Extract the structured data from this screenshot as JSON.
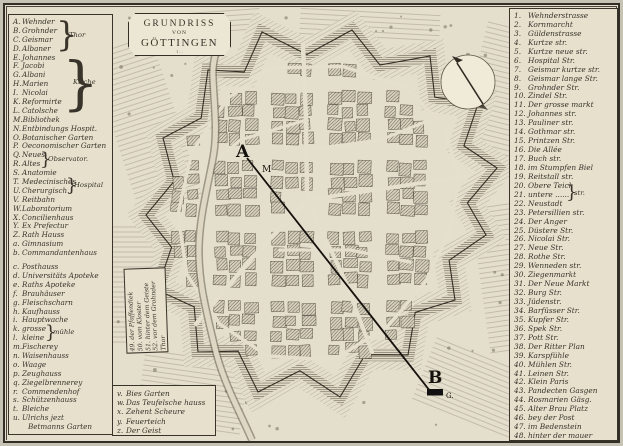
{
  "palette": {
    "paper": "#e4decc",
    "ink": "#39342b",
    "margin": "#c7c3b4",
    "hatch": "#554f41"
  },
  "title": {
    "line1": "GRUNDRISS",
    "line2": "VON",
    "line3": "GÖTTINGEN",
    "scale_mark": "1 : ."
  },
  "left_legend": {
    "brace_glyph": "}",
    "braces": {
      "thor": "Thor",
      "kirche": "Kirche",
      "observatory": "Observator.",
      "hospital": "Hospital",
      "muehle": "mühle"
    },
    "items": [
      {
        "k": "A.",
        "t": "Wehnder"
      },
      {
        "k": "B.",
        "t": "Grohnder"
      },
      {
        "k": "C.",
        "t": "Geismar"
      },
      {
        "k": "D.",
        "t": "Albaner"
      },
      {
        "k": "E.",
        "t": "Johannes"
      },
      {
        "k": "F.",
        "t": "Jacobi"
      },
      {
        "k": "G.",
        "t": "Albani"
      },
      {
        "k": "H.",
        "t": "Marien"
      },
      {
        "k": "I.",
        "t": "Nicolai"
      },
      {
        "k": "K.",
        "t": "Reformirte"
      },
      {
        "k": "L.",
        "t": "Catolsche"
      },
      {
        "k": "M.",
        "t": "Bibliothek"
      },
      {
        "k": "N.",
        "t": "Entbindungs Hospit."
      },
      {
        "k": "O.",
        "t": "Botanischer Garten"
      },
      {
        "k": "P.",
        "t": "Oeconomischer Garten"
      },
      {
        "k": "Q.",
        "t": "Neues"
      },
      {
        "k": "R.",
        "t": "Altes"
      },
      {
        "k": "S.",
        "t": "Anatomie"
      },
      {
        "k": "T.",
        "t": "Medecinisches"
      },
      {
        "k": "U.",
        "t": "Cherurgisch."
      },
      {
        "k": "V.",
        "t": "Reitbahn"
      },
      {
        "k": "W.",
        "t": "Laboratorium"
      },
      {
        "k": "X.",
        "t": "Concilienhaus"
      },
      {
        "k": "Y.",
        "t": "Ex Prefectur"
      },
      {
        "k": "Z.",
        "t": "Rath Hauss"
      },
      {
        "k": "a.",
        "t": "Gimnasium"
      },
      {
        "k": "b.",
        "t": "Commandantenhaus"
      },
      {
        "k": "c.",
        "t": "Posthauss"
      },
      {
        "k": "d.",
        "t": "Universitäts Apoteke"
      },
      {
        "k": "e.",
        "t": "Raths Apoteke"
      },
      {
        "k": "f.",
        "t": "Brauhäuser"
      },
      {
        "k": "g.",
        "t": "Fleischscharn"
      },
      {
        "k": "h.",
        "t": "Kaufhauss"
      },
      {
        "k": "i.",
        "t": "Hauptwache"
      },
      {
        "k": "k.",
        "t": "grosse"
      },
      {
        "k": "l.",
        "t": "kleine"
      },
      {
        "k": "m.",
        "t": "Fischerey"
      },
      {
        "k": "n.",
        "t": "Waisenhauss"
      },
      {
        "k": "o.",
        "t": "Waage"
      },
      {
        "k": "p.",
        "t": "Zeughauss"
      },
      {
        "k": "q.",
        "t": "Ziegelbrennerey"
      },
      {
        "k": "r.",
        "t": "Commendenhof"
      },
      {
        "k": "s.",
        "t": "Schützenhauss"
      },
      {
        "k": "t.",
        "t": "Bleiche"
      },
      {
        "k": "u.",
        "t": "Ulrichs jezt"
      },
      {
        "k": "",
        "t": "Betmanns Garten"
      }
    ]
  },
  "right_legend": {
    "brace_glyph": "}",
    "brace_label": "str.",
    "items": [
      {
        "n": "1.",
        "t": "Wehnderstrasse"
      },
      {
        "n": "2.",
        "t": "Kornmarcht"
      },
      {
        "n": "3.",
        "t": "Güldenstrasse"
      },
      {
        "n": "4.",
        "t": "Kurtze str."
      },
      {
        "n": "5.",
        "t": "Kurtze neue str."
      },
      {
        "n": "6.",
        "t": "Hospital Str."
      },
      {
        "n": "7.",
        "t": "Geismar kurtze str."
      },
      {
        "n": "8.",
        "t": "Geismar lange Str."
      },
      {
        "n": "9.",
        "t": "Grohnder Str."
      },
      {
        "n": "10.",
        "t": "Zindel Str."
      },
      {
        "n": "11.",
        "t": "Der grosse markt"
      },
      {
        "n": "12.",
        "t": "Johannes str."
      },
      {
        "n": "13.",
        "t": "Pauliner str."
      },
      {
        "n": "14.",
        "t": "Gothmar str."
      },
      {
        "n": "15.",
        "t": "Printzen Str."
      },
      {
        "n": "16.",
        "t": "Die Allée"
      },
      {
        "n": "17.",
        "t": "Buch str."
      },
      {
        "n": "18.",
        "t": "im Stumpfen Biel"
      },
      {
        "n": "19.",
        "t": "Reitstall str."
      },
      {
        "n": "20.",
        "t": "Obere Teich"
      },
      {
        "n": "21.",
        "t": "untere ......"
      },
      {
        "n": "22.",
        "t": "Neustadt"
      },
      {
        "n": "23.",
        "t": "Petersillien str."
      },
      {
        "n": "24.",
        "t": "Der Anger"
      },
      {
        "n": "25.",
        "t": "Düstere Str."
      },
      {
        "n": "26.",
        "t": "Nicolai Str."
      },
      {
        "n": "27.",
        "t": "Neue Str."
      },
      {
        "n": "28.",
        "t": "Rothe Str."
      },
      {
        "n": "29.",
        "t": "Wenneden str."
      },
      {
        "n": "30.",
        "t": "Ziegenmarkt"
      },
      {
        "n": "31.",
        "t": "Der Neue Markt"
      },
      {
        "n": "32.",
        "t": "Burg Str."
      },
      {
        "n": "33.",
        "t": "Jüdenstr."
      },
      {
        "n": "34.",
        "t": "Barfüsser Str."
      },
      {
        "n": "35.",
        "t": "Kupfer Str."
      },
      {
        "n": "36.",
        "t": "Spek Str."
      },
      {
        "n": "37.",
        "t": "Pott Str."
      },
      {
        "n": "38.",
        "t": "Der Ritter Plan"
      },
      {
        "n": "39.",
        "t": "Karspfühle"
      },
      {
        "n": "40.",
        "t": "Mühlen Str."
      },
      {
        "n": "41.",
        "t": "Leinen Str."
      },
      {
        "n": "42.",
        "t": "Klein Paris"
      },
      {
        "n": "43.",
        "t": "Pandecten Gasgen"
      },
      {
        "n": "44.",
        "t": "Rosmarien Gäsg."
      },
      {
        "n": "45.",
        "t": "Alter Brau Platz"
      },
      {
        "n": "46.",
        "t": "bey der Post"
      },
      {
        "n": "47.",
        "t": "im Bedenstein"
      },
      {
        "n": "48.",
        "t": "hinter der mauer"
      }
    ]
  },
  "rotated_legend": {
    "items": [
      {
        "t": "49. der Pfaffendiek"
      },
      {
        "t": "50. vom Kloster"
      },
      {
        "t": "51. hinter dem Geiste"
      },
      {
        "t": "52. vor dem Grohnder"
      },
      {
        "t": "      Thor"
      }
    ]
  },
  "bottom_legend": {
    "items": [
      {
        "k": "v.",
        "t": "Bies Garten"
      },
      {
        "k": "w.",
        "t": "Das Teufelsche hauss"
      },
      {
        "k": "x.",
        "t": "Zehent Scheure"
      },
      {
        "k": "y.",
        "t": "Feuerteich"
      },
      {
        "k": "z.",
        "t": "Der Geist"
      }
    ]
  },
  "annotations": {
    "a": "A",
    "b": "B",
    "m": "M",
    "g": "G."
  }
}
